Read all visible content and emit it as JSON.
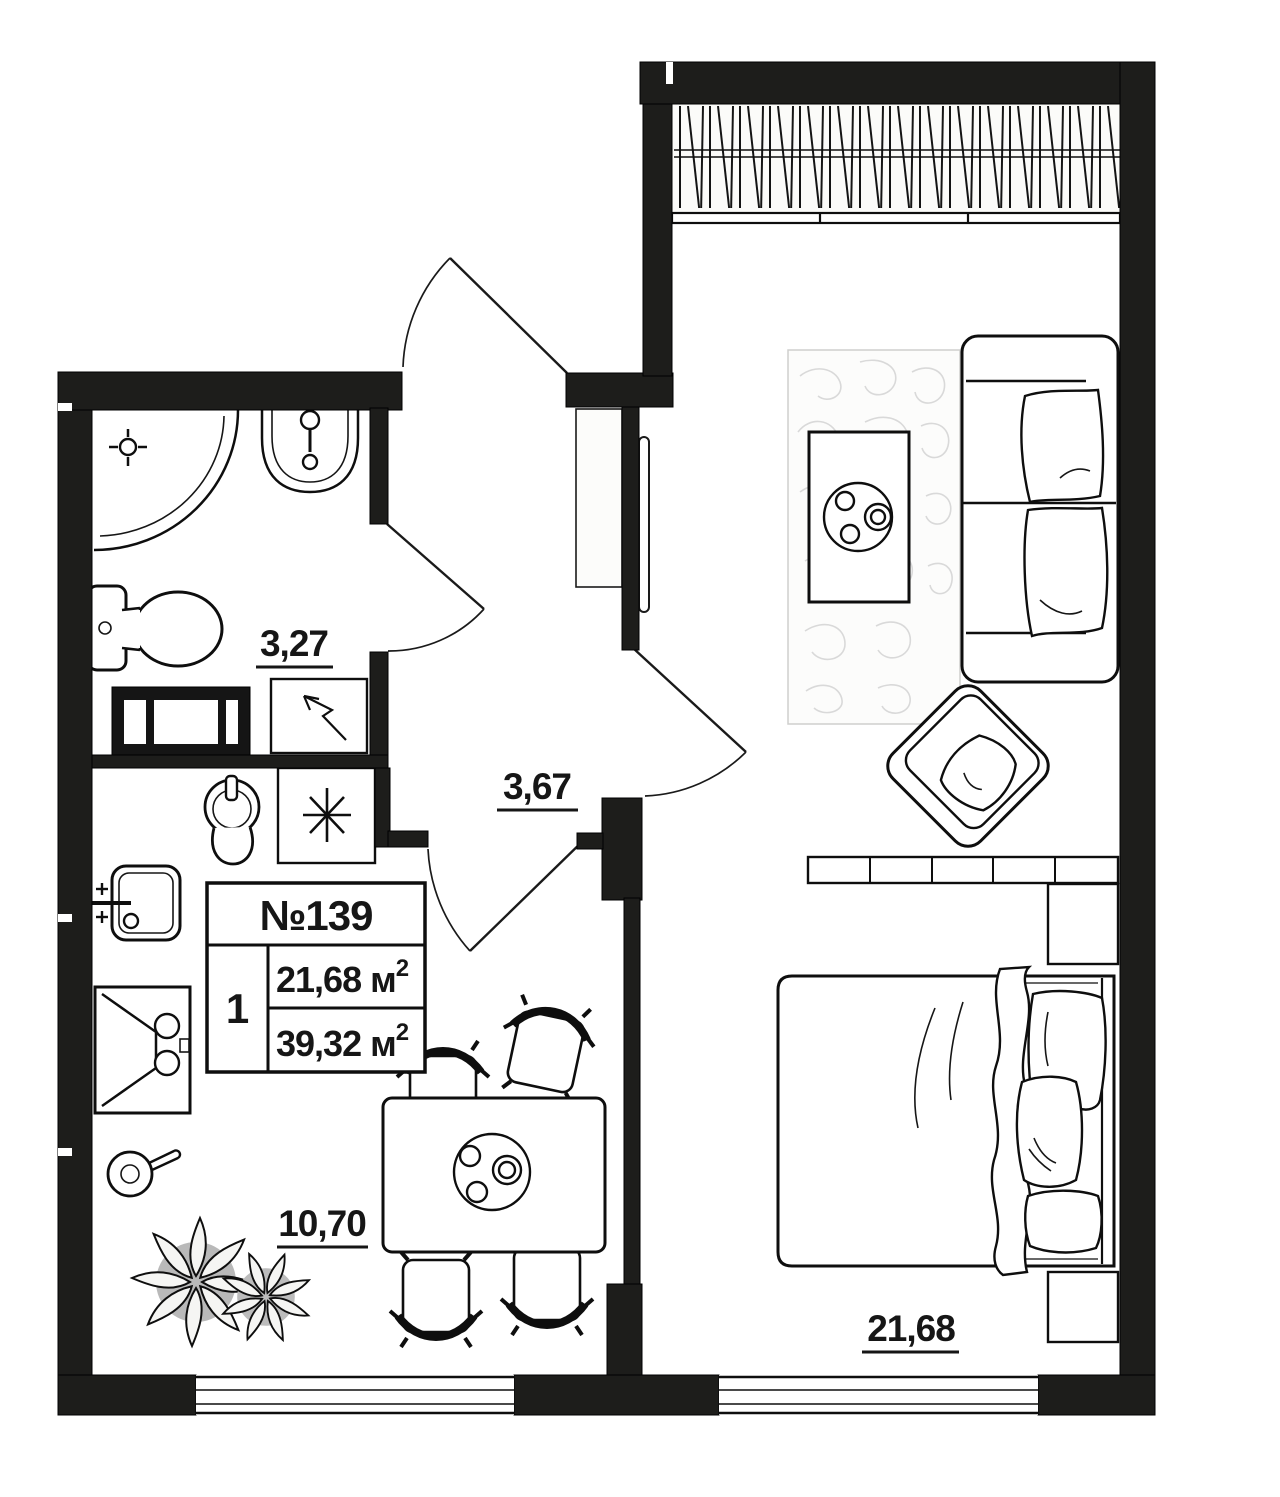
{
  "info_table": {
    "number": "№139",
    "rooms_count": "1",
    "living_area": "21,68 м",
    "total_area": "39,32 м",
    "area_superscript": "2"
  },
  "room_labels": {
    "bathroom": "3,27",
    "hallway": "3,67",
    "kitchen_living": "10,70",
    "bedroom": "21,68"
  },
  "colors": {
    "wall": "#1d1d1b",
    "line": "#0e0e0e",
    "background": "#ffffff",
    "rug_texture": "#d9d9d9"
  }
}
